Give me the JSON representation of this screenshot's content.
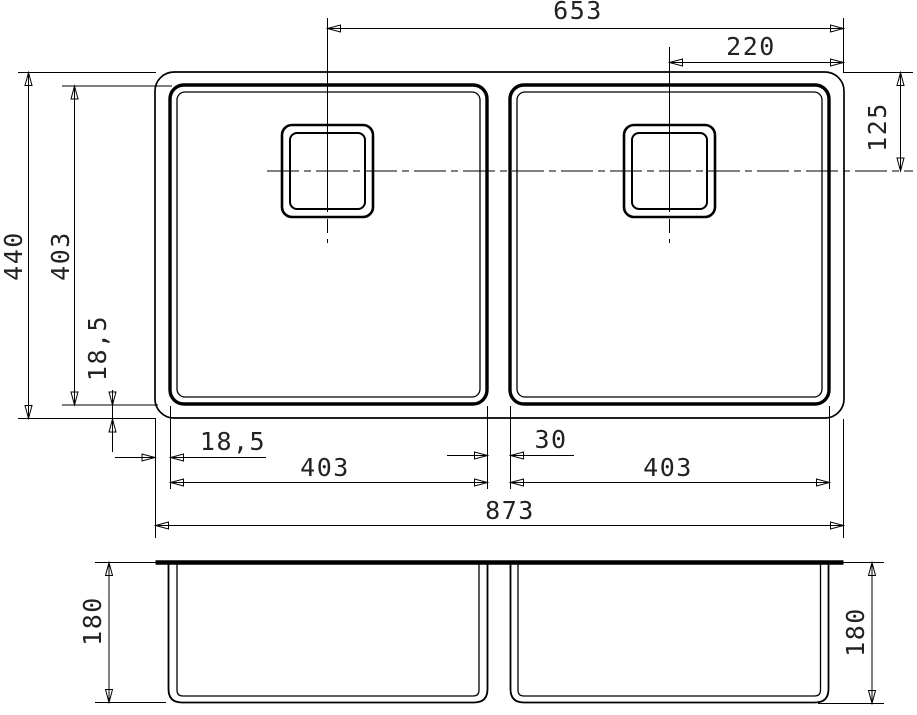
{
  "page": {
    "background": "#ffffff",
    "ink": "#000000"
  },
  "labels": {
    "top_653": "653",
    "top_220": "220",
    "right_125": "125",
    "left_440": "440",
    "left_403": "403",
    "left_18_5": "18,5",
    "bottom_18_5": "18,5",
    "bottom_403_left": "403",
    "bottom_30": "30",
    "bottom_403_right": "403",
    "bottom_873": "873",
    "side_180_left": "180",
    "side_180_right": "180"
  }
}
